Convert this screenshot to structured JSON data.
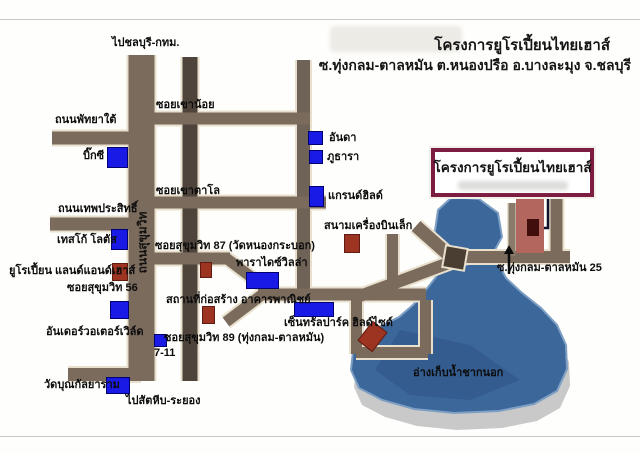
{
  "header": {
    "title": "โครงการยูโรเปี้ยนไทยเฮาส์",
    "subtitle": "ซ.ทุ่งกลม-ตาลหมัน ต.หนองปรือ อ.บางละมุง จ.ชลบุรี"
  },
  "sign": {
    "text": "โครงการยูโรเปี้ยนไทยเฮาส์",
    "border_color": "#7c1c40"
  },
  "labels": {
    "to_chonburi": "ไปชลบุรี-กทม.",
    "soi_khao_noi": "ซอยเขาน้อย",
    "pattaya_tai_rd": "ถนนพัทยาใต้",
    "big_c": "บิ๊กซี",
    "anda": "อันดา",
    "phuthara": "ภูธารา",
    "soi_khao_talo": "ซอยเขาตาโล",
    "grand_hill": "แกรนด์ฮิลด์",
    "thepprasit_rd": "ถนนเทพประสิทธิ์",
    "airfield": "สนามเครื่องบินเล็ก",
    "tesco_lotus": "เทสโก้ โลตัส",
    "soi_87": "ซอยสุขุมวิท 87 (วัดหนองกระบอก)",
    "euro_land_house": "ยูโรเปี้ยน แลนด์แอนด์เฮาส์",
    "paradise_villa": "พาราไดซ์วิลล่า",
    "soi_56": "ซอยสุขุมวิท 56",
    "construction": "สถานที่ก่อสร้าง อาคารพาณิชย์",
    "underwater_world": "อันเดอร์วอเตอร์เวิล์ด",
    "central_park": "เซ็นทรัลปาร์ค ฮิลด์ไซด์",
    "soi_89": "ซอยสุขุมวิท 89 (ทุ่งกลม-ตาลหมัน)",
    "seven_eleven": "7-11",
    "wat_bun": "วัดบุณกัลยาราม",
    "to_sattahip": "ไปสัตหีบ-ระยอง",
    "soi_25": "ซ.ทุ่งกลม-ตาลหมัน 25",
    "reservoir": "อ่างเก็บน้ำชากนอก",
    "sukhumvit_rd": "ถนนสุขุมวิท"
  },
  "colors": {
    "road": "#7a6b5d",
    "road_dark": "#4e443b",
    "road_minor": "#6f6357",
    "road_outline": "#e8e0cc",
    "lake": "#3c679b",
    "lake_shadow": "#c9c9c9",
    "landmark_blue": "#1a1ae6",
    "landmark_red": "#9d3321",
    "project_strip": "#b2665e",
    "sign_border": "#7c1c40"
  }
}
